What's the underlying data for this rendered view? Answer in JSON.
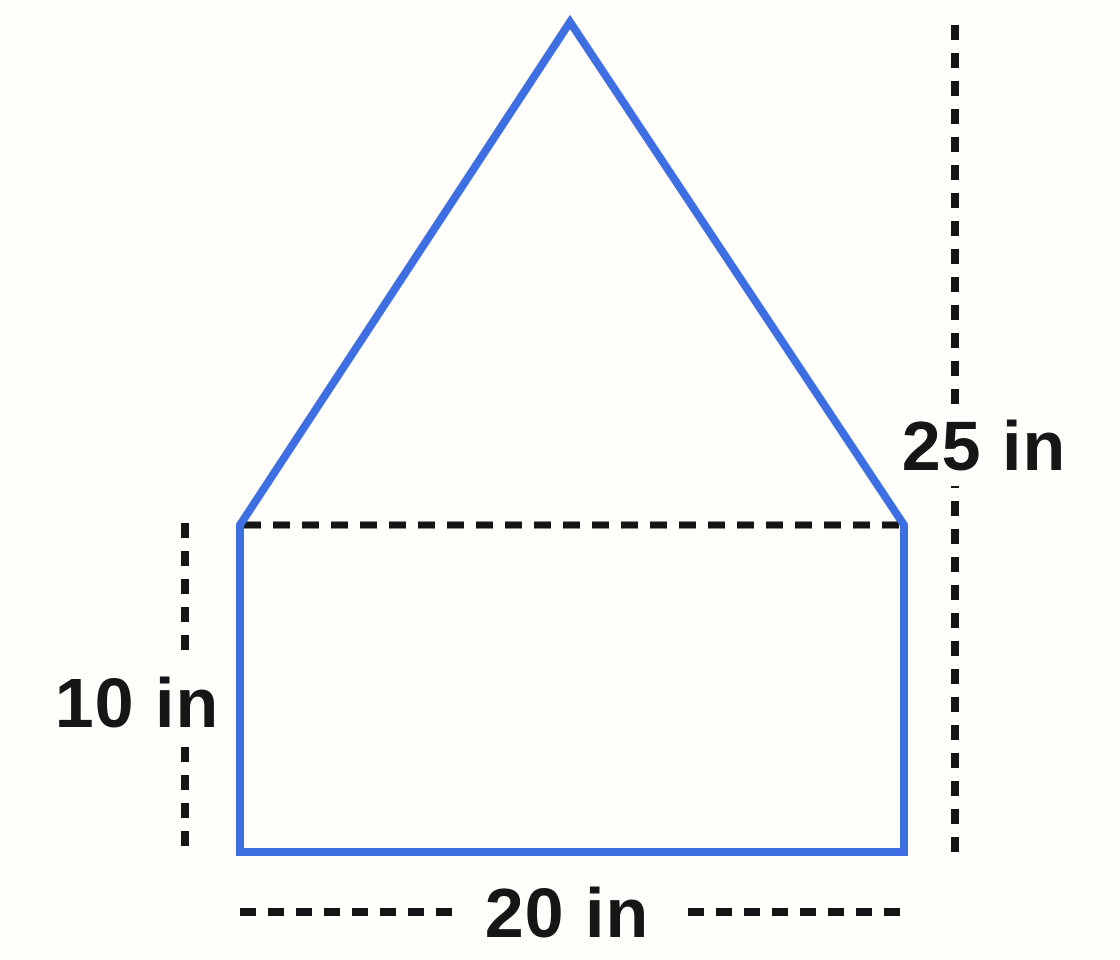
{
  "diagram": {
    "background": "#fffefb",
    "shape": {
      "kind": "house-pentagon (rectangle with triangular top)",
      "stroke_color": "#3d6fe3"
    },
    "guides": {
      "color": "#151515",
      "style": "dashed"
    },
    "measurements": {
      "total_height": {
        "label": "25 in",
        "value": 25,
        "unit": "in"
      },
      "rectangle_height": {
        "label": "10 in",
        "value": 10,
        "unit": "in"
      },
      "rectangle_width": {
        "label": "20 in",
        "value": 20,
        "unit": "in"
      }
    }
  }
}
